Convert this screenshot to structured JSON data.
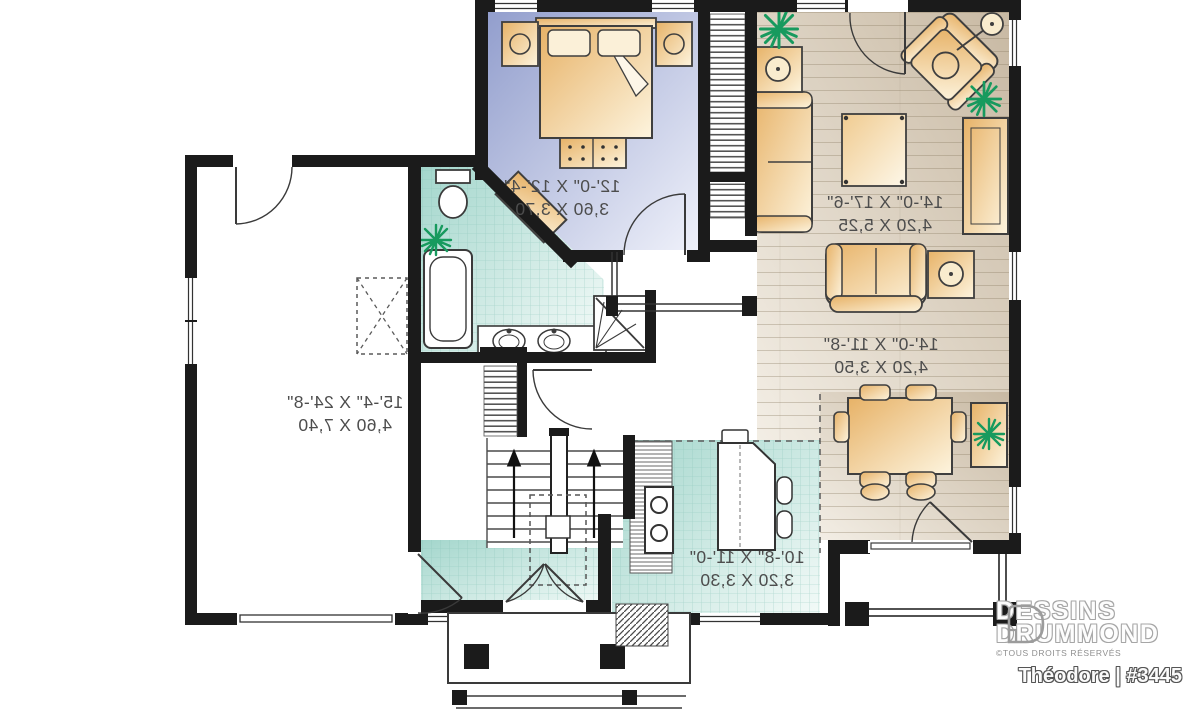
{
  "plan": {
    "rooms": [
      {
        "name": "bedroom",
        "imperial": "12'-0\" X 12'-4\"",
        "metric": "3,60 X 3,70"
      },
      {
        "name": "living-room",
        "imperial": "14'-0\" X 17'-6\"",
        "metric": "4,20 X 5,25"
      },
      {
        "name": "dining-room",
        "imperial": "14'-0\" X 11'-8\"",
        "metric": "4,20 X 3,50"
      },
      {
        "name": "garage",
        "imperial": "15'-4\" X 24'-8\"",
        "metric": "4,60 X 7,40"
      },
      {
        "name": "kitchen",
        "imperial": "10'-8\" X 11'-0\"",
        "metric": "3,20 X 3,30"
      }
    ],
    "colors": {
      "walls": "#1b1b1b",
      "bedroom_floor": "#929ecd",
      "wood_floor": "#c8b9a3",
      "tile_floor": "#a3d6cc",
      "furniture": "#e7b267",
      "plant": "#179a5e"
    }
  },
  "brand": {
    "name_line1": "DESSINS",
    "name_line2": "DRUMMOND",
    "copyright": "©TOUS DROITS RÉSERVÉS",
    "plan_title": "Théodore | #3445"
  }
}
